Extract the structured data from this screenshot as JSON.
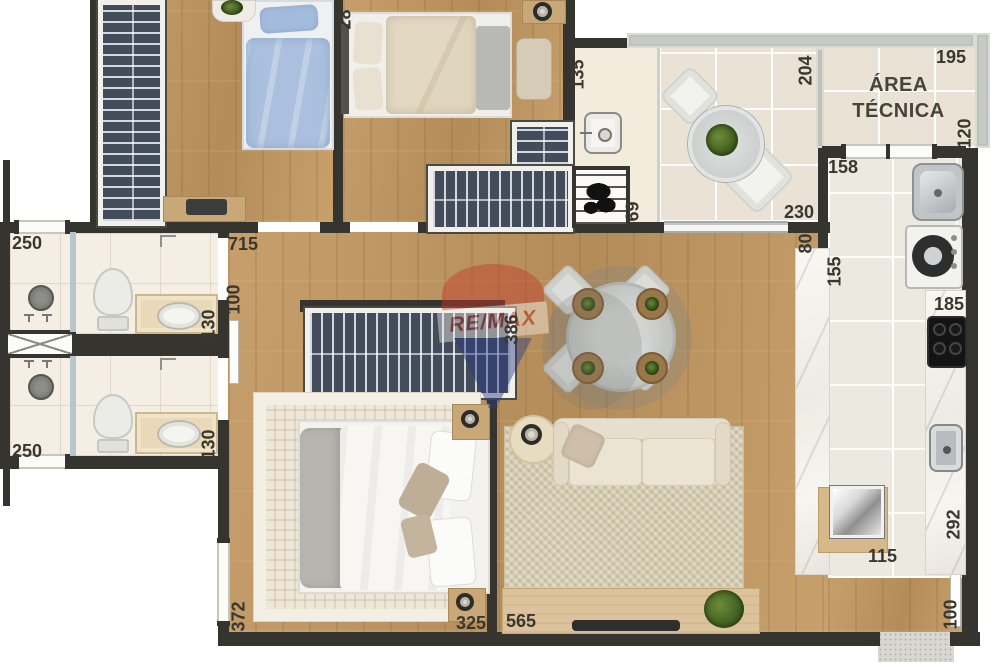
{
  "watermark": {
    "brand": "RE/MAX"
  },
  "rooms": {
    "area_tecnica": "ÁREA TÉCNICA"
  },
  "dim": {
    "b2_top": "28",
    "bath1_win": "250",
    "hall_len": "715",
    "hall_w": "100",
    "bath1_w": "130",
    "bath2_win": "250",
    "bath2_w": "130",
    "master_win": "372",
    "master_w": "325",
    "living_w": "565",
    "living_len": "386",
    "grill_w": "135",
    "grill_d": "69",
    "balcony_w": "204",
    "at_w": "195",
    "at_d": "120",
    "service_w": "158",
    "balcony_door": "230",
    "pass_w": "80",
    "service_d": "155",
    "counter_w": "185",
    "kitchen_len": "292",
    "kitchen_w": "115",
    "entry_w": "100"
  },
  "palette": {
    "wall": "#35342f",
    "wood": "#c19a66",
    "tile_bath": "#f4eee4",
    "tile_balcony": "#eae3d5",
    "tile_kitchen": "#ece9e1",
    "marble": "#f4f1ec",
    "bed_blue": "#abc0de",
    "remax_red": "#c23a2b",
    "remax_blue": "#2c3a85",
    "label": "#3a382e"
  }
}
